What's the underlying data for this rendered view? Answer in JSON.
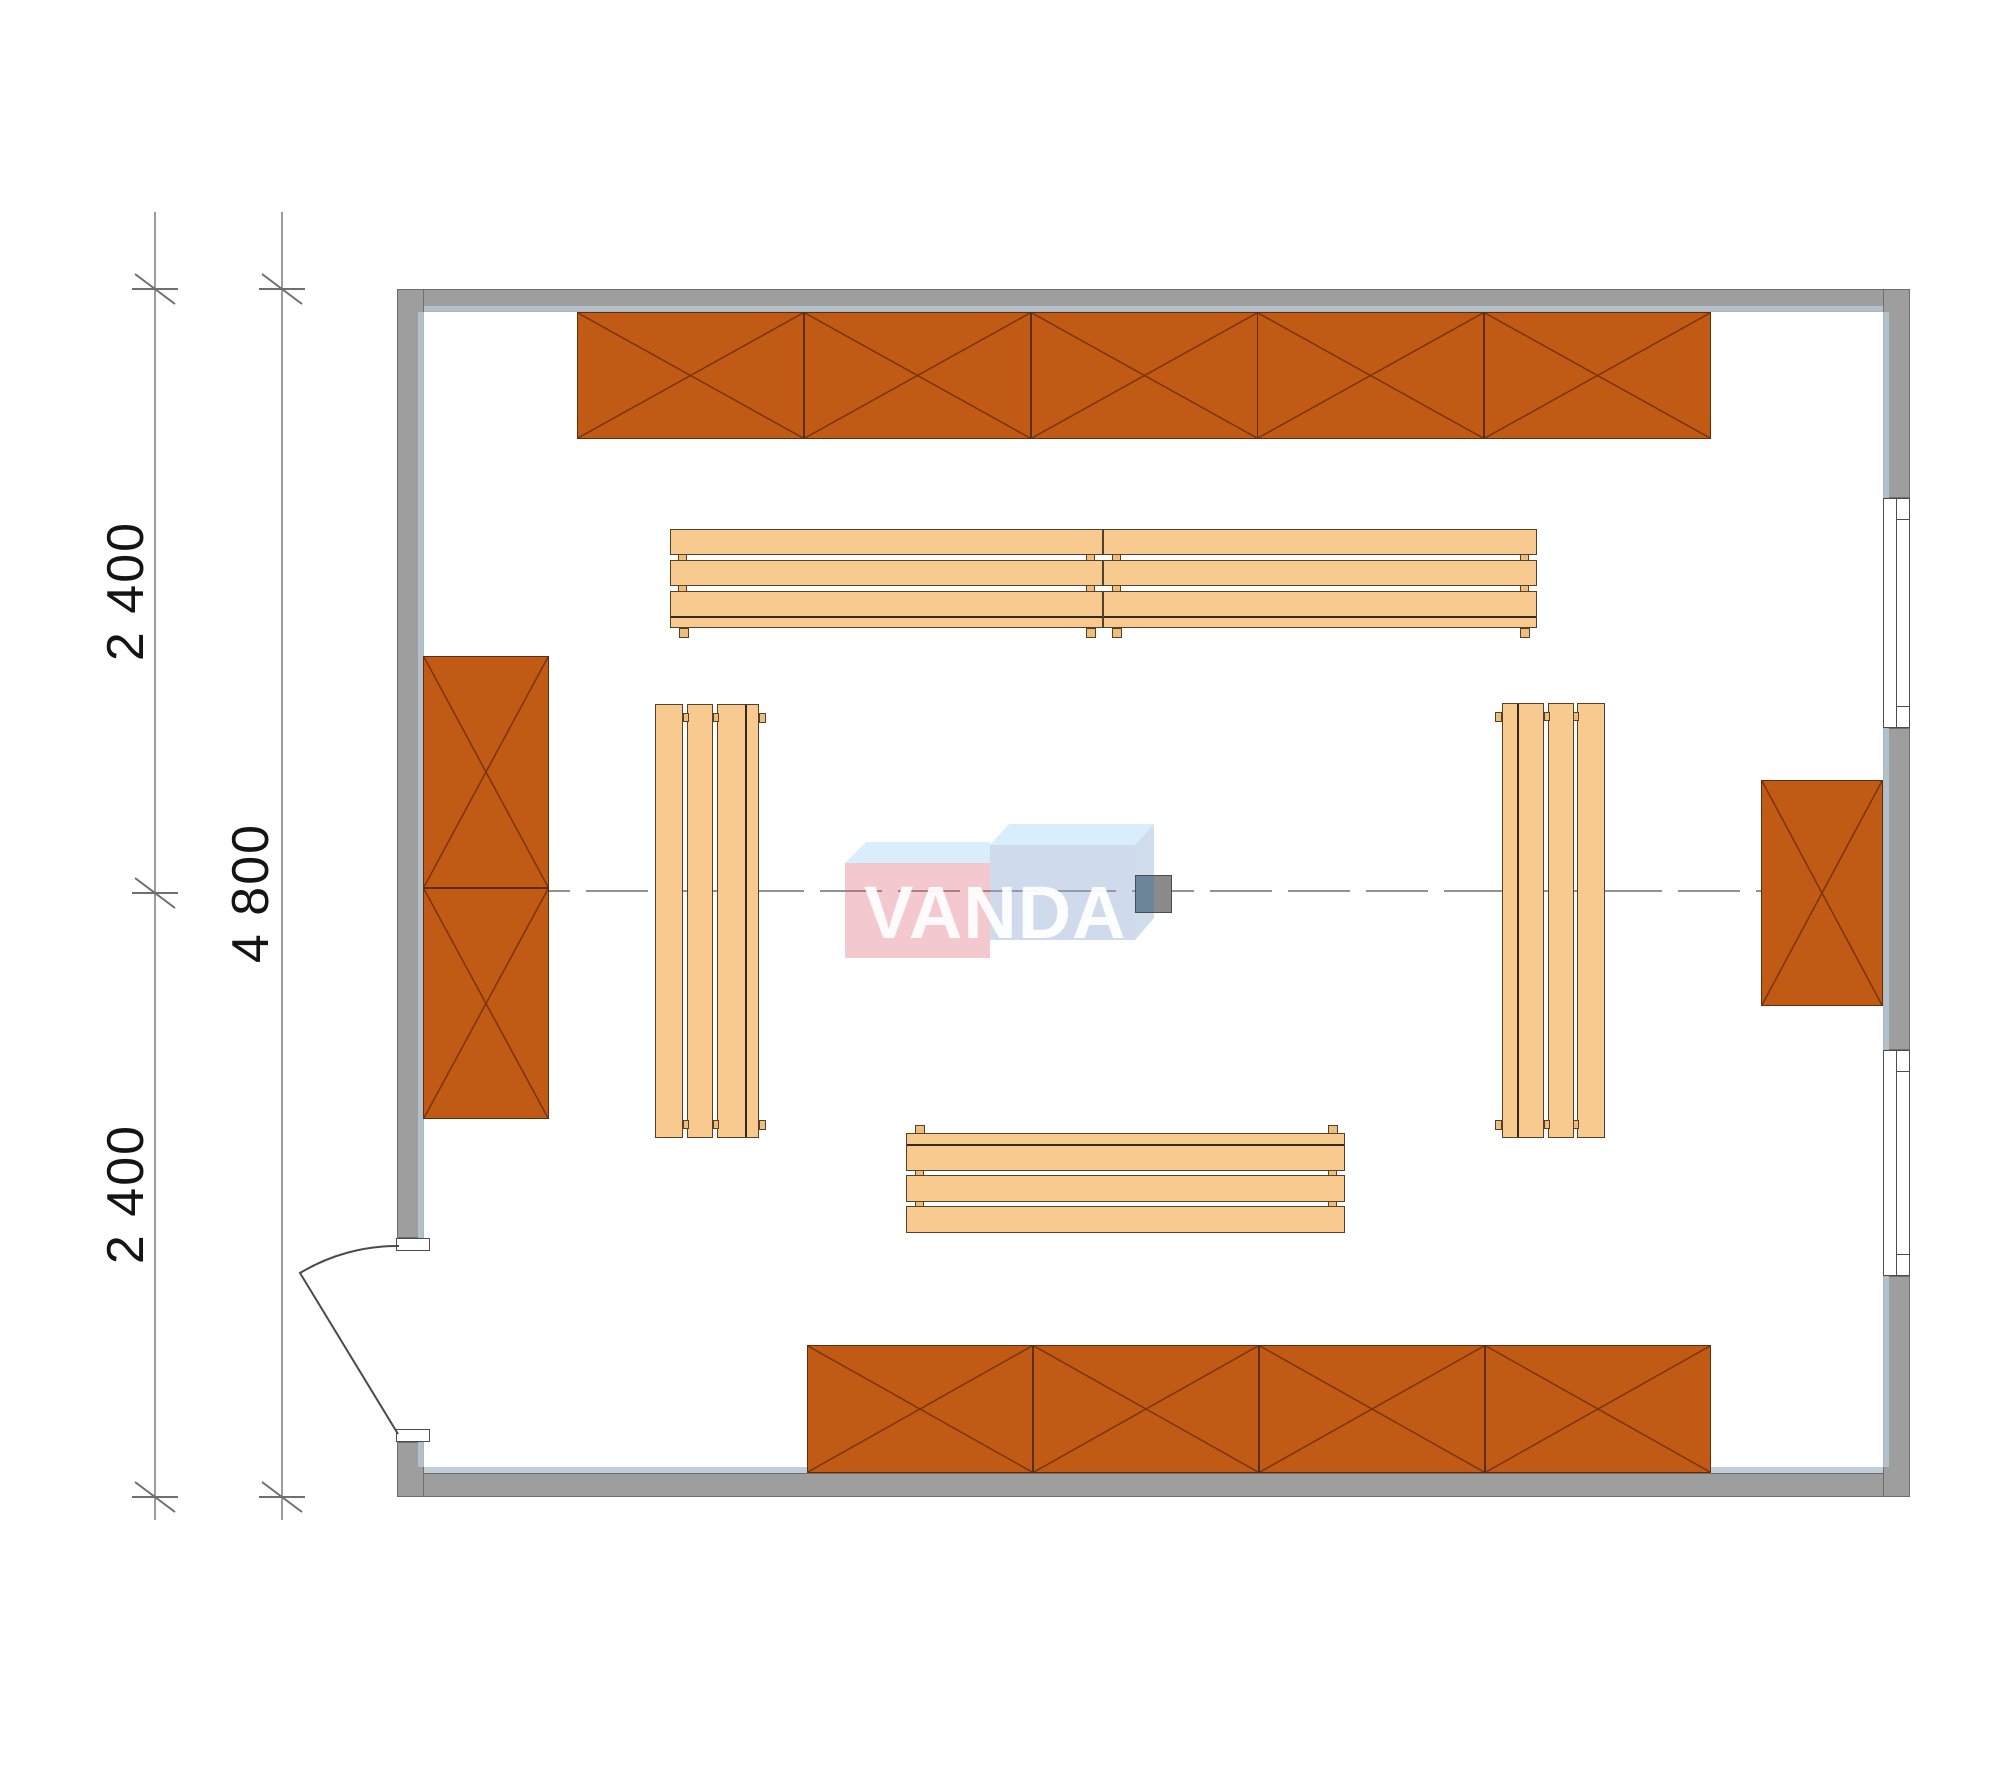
{
  "drawing": {
    "type": "furniture floor plan (sauna / shop room)",
    "dimensions": {
      "left_segment_top": "2 400",
      "left_segment_bottom": "2 400",
      "left_total": "4 800"
    },
    "watermark": {
      "text": "VANDA"
    },
    "palette": {
      "wall_gray": "#9e9e9e",
      "wall_inner_liner": "#b6c5d0",
      "shelving_orange": "#c05a14",
      "shelving_cross": "#7c3407",
      "bench_wood": "#f9ca90",
      "bench_edge": "#54412a",
      "centerline_gray": "#6e6e6e",
      "dimension_gray": "#6f6f6f",
      "watermark_pink": "#f5c6cd",
      "watermark_blue": "#cdd9ea",
      "column_gray": "#8a8a8a"
    },
    "inventory": {
      "crossed_shelving_units_top_row": 5,
      "crossed_shelving_units_bottom_row": 4,
      "crossed_shelving_units_left_wall": 2,
      "crossed_shelving_units_right_wall": 1,
      "bench_segments_top": 2,
      "bench_segments_bottom": 1,
      "benches_vertical": 2,
      "windows_right_wall": 2,
      "doors_left_wall": 1,
      "center_columns": 1
    }
  }
}
